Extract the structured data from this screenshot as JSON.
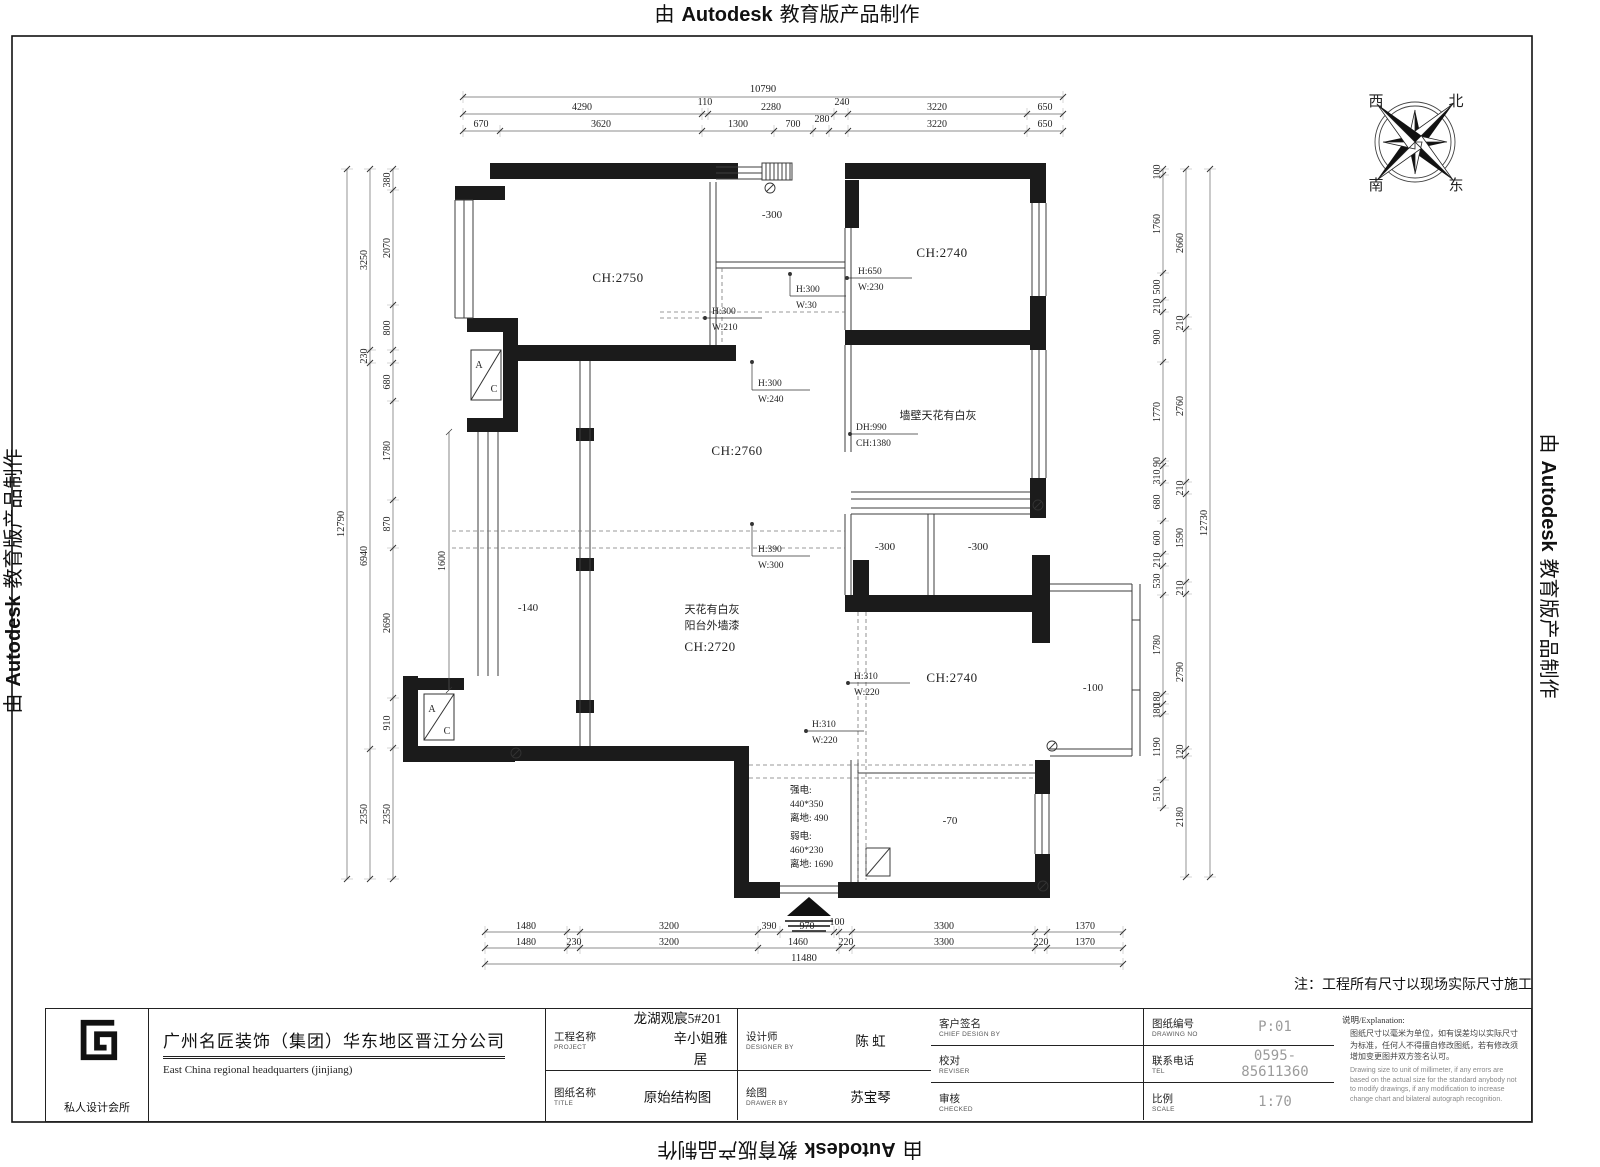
{
  "banner": {
    "prefix": "由",
    "brand": "Autodesk",
    "suffix": "教育版产品制作"
  },
  "frame_note": "注：工程所有尺寸以现场实际尺寸施工",
  "compass": {
    "nw": "西",
    "ne": "北",
    "sw": "南",
    "se": "东"
  },
  "plan": {
    "rooms": {
      "bedroom_top_left": "CH:2750",
      "bedroom_top_right": "CH:2740",
      "living": "CH:2760",
      "balcony_left_ch": "CH:2720",
      "bedroom_bottom_right": "CH:2740",
      "balcony_top_level": "-300",
      "bath_left_level": "-300",
      "bath_right_level": "-300",
      "balcony_left_level": "-140",
      "balcony_right_level": "-100",
      "entry_level": "-70"
    },
    "notes": {
      "wall_ceiling": "墙壁天花有白灰",
      "ceiling": "天花有白灰",
      "balcony_paint": "阳台外墙漆",
      "power_strong_1": "强电:",
      "power_strong_2": "440*350",
      "power_strong_3": "离地: 490",
      "power_weak_1": "弱电:",
      "power_weak_2": "460*230",
      "power_weak_3": "离地: 1690",
      "balcony_inner_dim": "1600",
      "ac_a": "A",
      "ac_c": "C"
    },
    "beams": {
      "b1": {
        "h": "H:650",
        "w": "W:230"
      },
      "b2": {
        "h": "H:300",
        "w": "W:30"
      },
      "b3": {
        "h": "H:300",
        "w": "W:210"
      },
      "b4": {
        "h": "H:300",
        "w": "W:240"
      },
      "b5": {
        "dh": "DH:990",
        "ch": "CH:1380"
      },
      "b6": {
        "h": "H:390",
        "w": "W:300"
      },
      "b7": {
        "h": "H:310",
        "w": "W:220"
      },
      "b8": {
        "h": "H:310",
        "w": "W:220"
      }
    },
    "dims": {
      "top": {
        "total": "10790",
        "row2": [
          "4290",
          "110",
          "2280",
          "240",
          "3220",
          "650"
        ],
        "row3": [
          "670",
          "3620",
          "1300",
          "700",
          "280",
          "3220",
          "650"
        ]
      },
      "bottom": {
        "row1": [
          "1480",
          "3200",
          "390",
          "970",
          "100",
          "3300",
          "1370"
        ],
        "row2": [
          "1480",
          "230",
          "3200",
          "1460",
          "220",
          "3300",
          "220",
          "1370"
        ],
        "total": "11480"
      },
      "left": {
        "total": "12790",
        "mid": [
          "3250",
          "230",
          "6940",
          "2350"
        ],
        "inner": [
          "380",
          "2070",
          "800",
          "680",
          "1780",
          "870",
          "2690",
          "910",
          "2350"
        ]
      },
      "right": {
        "total": "12730",
        "mid": [
          "2660",
          "210",
          "2760",
          "210",
          "1590",
          "210",
          "2790",
          "120",
          "2180"
        ],
        "inner": [
          "100",
          "1760",
          "500",
          "210",
          "900",
          "1770",
          "90",
          "310",
          "680",
          "600",
          "210",
          "530",
          "1780",
          "180",
          "180",
          "1190",
          "510"
        ]
      }
    }
  },
  "titleblock": {
    "logo_caption": "私人设计会所",
    "company_cn": "广州名匠装饰（集团）华东地区晋江分公司",
    "company_en": "East China regional headquarters (jinjiang)",
    "fields": {
      "project_label": "工程名称",
      "project_label_en": "PROJECT",
      "project_value_1": "龙湖观宸5#201",
      "project_value_2": "辛小姐雅居",
      "title_label": "图纸名称",
      "title_label_en": "TITLE",
      "title_value": "原始结构图",
      "designer_label": "设计师",
      "designer_label_en": "DESIGNER BY",
      "designer_value": "陈  虹",
      "drawer_label": "绘图",
      "drawer_label_en": "DRAWER BY",
      "drawer_value": "苏宝琴",
      "client_label": "客户签名",
      "client_label_en": "CHIEF DESIGN BY",
      "reviser_label": "校对",
      "reviser_label_en": "REVISER",
      "checker_label": "审核",
      "checker_label_en": "CHECKED",
      "drawing_no_label": "图纸编号",
      "drawing_no_label_en": "DRAWING NO",
      "drawing_no_value": "P:01",
      "tel_label": "联系电话",
      "tel_label_en": "TEL",
      "tel_value": "0595-85611360",
      "scale_label": "比例",
      "scale_label_en": "SCALE",
      "scale_value": "1:70"
    },
    "explanation": {
      "heading": "说明/Explanation:",
      "cn": "图纸尺寸以毫米为单位，如有误差均以实际尺寸为标准，任何人不得擅自修改图纸，若有修改须增加变更图并双方签名认可。",
      "en": "Drawing size to unit of millimeter, if any errors are based on the actual size for the standard anybody not to modify drawings, if any modification to increase change chart and bilateral autograph recognition."
    }
  },
  "colors": {
    "ink": "#1b1b1b",
    "value_gray": "#9b9b9b"
  }
}
